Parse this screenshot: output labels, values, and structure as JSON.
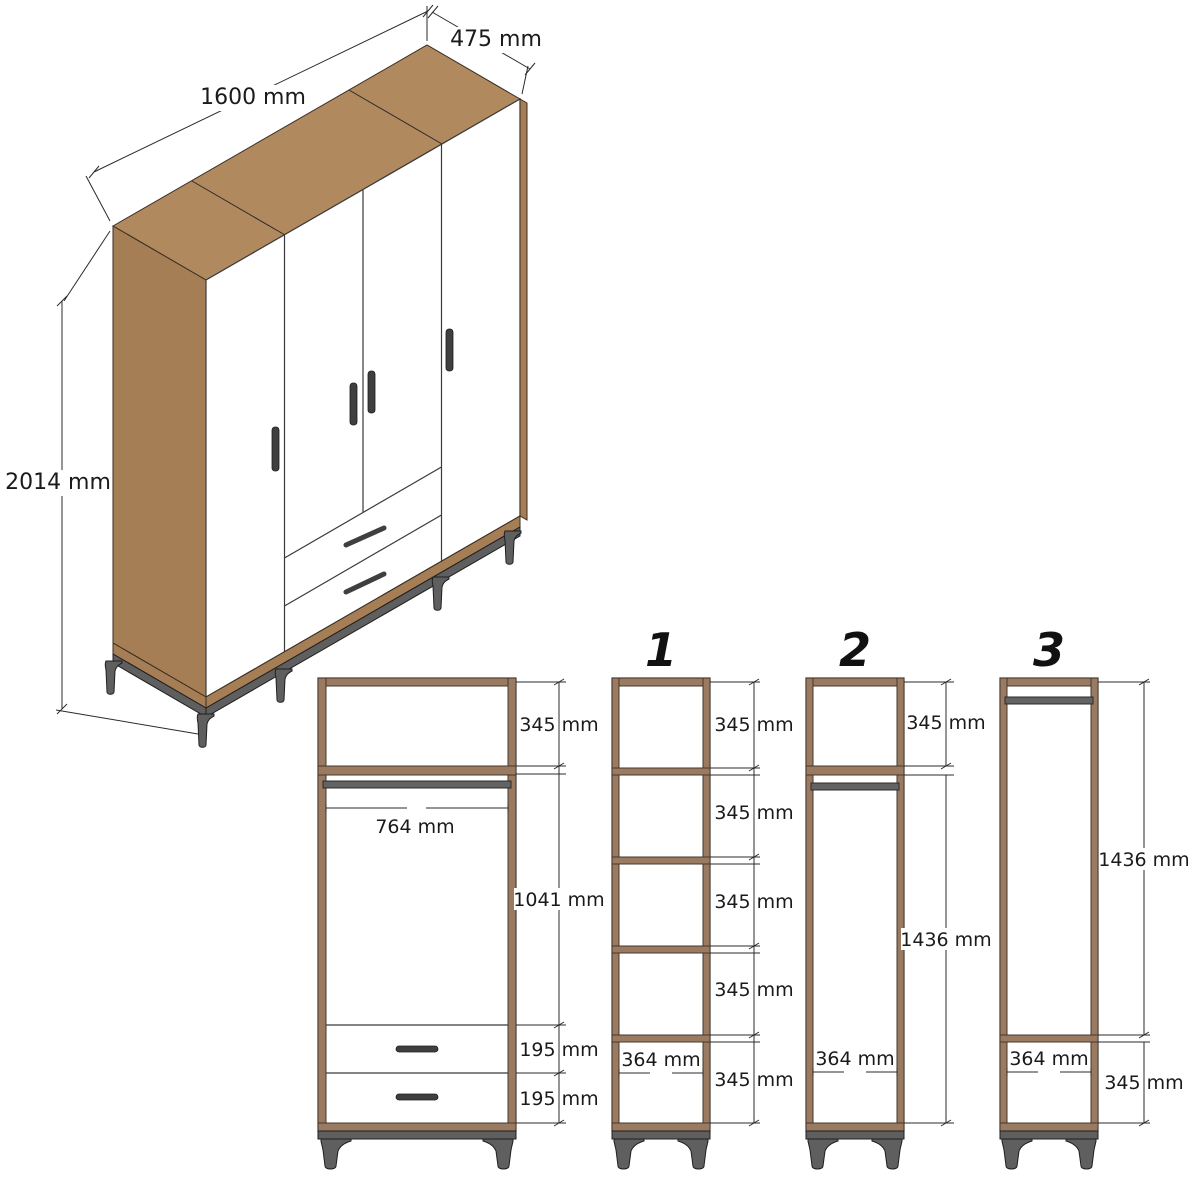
{
  "view3d": {
    "width_label": "1600 mm",
    "depth_label": "475 mm",
    "height_label": "2014 mm"
  },
  "front_view": {
    "top_shelf": "345 mm",
    "inner_width": "764 mm",
    "hanging_height": "1041 mm",
    "drawer_top": "195 mm",
    "drawer_bottom": "195 mm"
  },
  "section1": {
    "label": "1",
    "dims": [
      "345 mm",
      "345 mm",
      "345 mm",
      "345 mm",
      "345 mm"
    ],
    "inner_width": "364 mm"
  },
  "section2": {
    "label": "2",
    "top_shelf": "345 mm",
    "hanging_height": "1436 mm",
    "inner_width": "364 mm"
  },
  "section3": {
    "label": "3",
    "hanging_height": "1436 mm",
    "inner_width": "364 mm",
    "bottom_shelf": "345 mm"
  },
  "colors": {
    "wood": "#b1895f",
    "wood_shadow": "#a67e55",
    "frame_wood": "#9b7a62",
    "metal_legs": "#5f5f5f",
    "hanging_rod": "#636363",
    "dimension_lines": "#2b2b2b",
    "text": "#1a1a1a",
    "background": "#ffffff"
  }
}
